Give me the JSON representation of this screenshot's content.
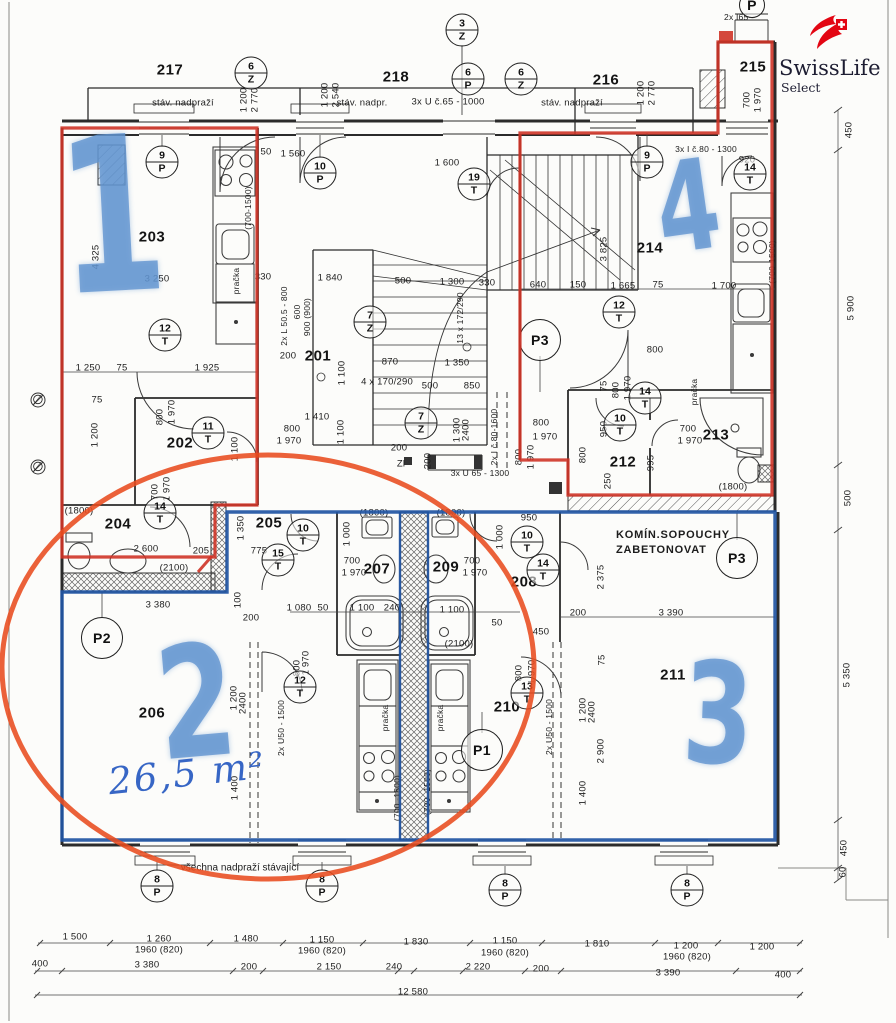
{
  "logo": {
    "title": "SwissLife",
    "subtitle": "Select"
  },
  "notes": {
    "area": "26,5 m²",
    "chimney_line1": "KOMÍN.SOPOUCHY",
    "chimney_line2": "ZABETONOVAT",
    "lintels": "všechna nadpraží stávající"
  },
  "colors": {
    "marker_red": "#cf3427",
    "ellipse_red": "#e84b1e",
    "outline_blue": "#2155a3",
    "handwritten_blue": "#6094d0",
    "logo_red": "#e30613",
    "wall": "#2b2b2b"
  },
  "apartment_marks": [
    {
      "n": "1",
      "x": 112,
      "y": 226,
      "s": 215,
      "rot": -3
    },
    {
      "n": "2",
      "x": 196,
      "y": 710,
      "s": 155,
      "rot": -5
    },
    {
      "n": "3",
      "x": 718,
      "y": 722,
      "s": 140,
      "rot": 2
    },
    {
      "n": "4",
      "x": 688,
      "y": 214,
      "s": 125,
      "rot": -8
    }
  ],
  "room_labels": [
    {
      "t": "217",
      "x": 170,
      "y": 70
    },
    {
      "t": "218",
      "x": 396,
      "y": 77
    },
    {
      "t": "216",
      "x": 606,
      "y": 80
    },
    {
      "t": "215",
      "x": 753,
      "y": 67
    },
    {
      "t": "203",
      "x": 152,
      "y": 237
    },
    {
      "t": "201",
      "x": 318,
      "y": 356
    },
    {
      "t": "202",
      "x": 180,
      "y": 443
    },
    {
      "t": "214",
      "x": 650,
      "y": 248
    },
    {
      "t": "212",
      "x": 623,
      "y": 462
    },
    {
      "t": "213",
      "x": 716,
      "y": 435
    },
    {
      "t": "204",
      "x": 118,
      "y": 524
    },
    {
      "t": "205",
      "x": 269,
      "y": 523
    },
    {
      "t": "207",
      "x": 377,
      "y": 569
    },
    {
      "t": "209",
      "x": 446,
      "y": 567
    },
    {
      "t": "208",
      "x": 524,
      "y": 582
    },
    {
      "t": "206",
      "x": 152,
      "y": 713
    },
    {
      "t": "210",
      "x": 507,
      "y": 707
    },
    {
      "t": "211",
      "x": 673,
      "y": 675
    }
  ],
  "circles": [
    {
      "t": "P",
      "x": 752,
      "y": 5,
      "d": 24,
      "plain": true
    },
    {
      "t": "3",
      "b": "Z",
      "x": 462,
      "y": 30
    },
    {
      "t": "6",
      "b": "Z",
      "x": 251,
      "y": 73
    },
    {
      "t": "6",
      "b": "P",
      "x": 468,
      "y": 79
    },
    {
      "t": "6",
      "b": "Z",
      "x": 521,
      "y": 79
    },
    {
      "t": "9",
      "b": "P",
      "x": 162,
      "y": 162
    },
    {
      "t": "10",
      "b": "P",
      "x": 320,
      "y": 173
    },
    {
      "t": "19",
      "b": "T",
      "x": 474,
      "y": 184
    },
    {
      "t": "9",
      "b": "P",
      "x": 647,
      "y": 162
    },
    {
      "t": "14",
      "b": "T",
      "x": 750,
      "y": 174
    },
    {
      "t": "12",
      "b": "T",
      "x": 165,
      "y": 335
    },
    {
      "t": "7",
      "b": "Z",
      "x": 370,
      "y": 322
    },
    {
      "t": "P3",
      "x": 540,
      "y": 340,
      "plain": true
    },
    {
      "t": "12",
      "b": "T",
      "x": 619,
      "y": 312
    },
    {
      "t": "11",
      "b": "T",
      "x": 208,
      "y": 433
    },
    {
      "t": "7",
      "b": "Z",
      "x": 421,
      "y": 423
    },
    {
      "t": "14",
      "b": "T",
      "x": 645,
      "y": 398
    },
    {
      "t": "10",
      "b": "T",
      "x": 620,
      "y": 425
    },
    {
      "t": "14",
      "b": "T",
      "x": 160,
      "y": 513
    },
    {
      "t": "10",
      "b": "T",
      "x": 303,
      "y": 535
    },
    {
      "t": "15",
      "b": "T",
      "x": 278,
      "y": 560
    },
    {
      "t": "10",
      "b": "T",
      "x": 527,
      "y": 542
    },
    {
      "t": "14",
      "b": "T",
      "x": 543,
      "y": 570
    },
    {
      "t": "P3",
      "x": 737,
      "y": 558,
      "plain": true
    },
    {
      "t": "P2",
      "x": 102,
      "y": 638,
      "plain": true
    },
    {
      "t": "12",
      "b": "T",
      "x": 300,
      "y": 687
    },
    {
      "t": "13",
      "b": "T",
      "x": 527,
      "y": 693
    },
    {
      "t": "P1",
      "x": 482,
      "y": 750,
      "plain": true
    },
    {
      "t": "8",
      "b": "P",
      "x": 157,
      "y": 886
    },
    {
      "t": "8",
      "b": "P",
      "x": 322,
      "y": 886
    },
    {
      "t": "8",
      "b": "P",
      "x": 505,
      "y": 890
    },
    {
      "t": "8",
      "b": "P",
      "x": 687,
      "y": 890
    }
  ],
  "dim_labels": [
    {
      "t": "stáv. nadpraží",
      "x": 183,
      "y": 103
    },
    {
      "t": "1 200",
      "x": 244,
      "y": 100,
      "r": 1
    },
    {
      "t": "2 770",
      "x": 255,
      "y": 100,
      "r": 1
    },
    {
      "t": "1 200",
      "x": 325,
      "y": 95,
      "r": 1
    },
    {
      "t": "2 540",
      "x": 336,
      "y": 95,
      "r": 1
    },
    {
      "t": "stáv. nadpr.",
      "x": 362,
      "y": 103
    },
    {
      "t": "3x U č.65 - 1000",
      "x": 448,
      "y": 102
    },
    {
      "t": "stáv. nadpraží",
      "x": 572,
      "y": 103
    },
    {
      "t": "1 200",
      "x": 641,
      "y": 93,
      "r": 1
    },
    {
      "t": "2 770",
      "x": 652,
      "y": 93,
      "r": 1
    },
    {
      "t": "2x I65 -",
      "x": 739,
      "y": 17,
      "fs": 8.5
    },
    {
      "t": "700",
      "x": 747,
      "y": 100,
      "r": 1
    },
    {
      "t": "1 970",
      "x": 758,
      "y": 100,
      "r": 1
    },
    {
      "t": "3x I č.80 - 1300",
      "x": 706,
      "y": 149,
      "fs": 8.5
    },
    {
      "t": "920",
      "x": 747,
      "y": 160
    },
    {
      "t": "50",
      "x": 266,
      "y": 152
    },
    {
      "t": "1 560",
      "x": 293,
      "y": 154
    },
    {
      "t": "1 600",
      "x": 447,
      "y": 163
    },
    {
      "t": "4 325",
      "x": 96,
      "y": 257,
      "r": 1
    },
    {
      "t": "3 250",
      "x": 157,
      "y": 279
    },
    {
      "t": "330",
      "x": 263,
      "y": 277
    },
    {
      "t": "pračka",
      "x": 236,
      "y": 281,
      "r": 1,
      "fs": 8.5
    },
    {
      "t": "(700-1500)",
      "x": 248,
      "y": 208,
      "r": 1,
      "fs": 8.5
    },
    {
      "t": "1 250",
      "x": 88,
      "y": 368
    },
    {
      "t": "75",
      "x": 122,
      "y": 368
    },
    {
      "t": "1 925",
      "x": 207,
      "y": 368
    },
    {
      "t": "1 200",
      "x": 95,
      "y": 435,
      "r": 1
    },
    {
      "t": "75",
      "x": 97,
      "y": 400
    },
    {
      "t": "800",
      "x": 160,
      "y": 417,
      "r": 1
    },
    {
      "t": "1 970",
      "x": 172,
      "y": 412,
      "r": 1
    },
    {
      "t": "1 100",
      "x": 235,
      "y": 449,
      "r": 1
    },
    {
      "t": "700",
      "x": 155,
      "y": 492,
      "r": 1
    },
    {
      "t": "1 970",
      "x": 167,
      "y": 489,
      "r": 1
    },
    {
      "t": "1 840",
      "x": 330,
      "y": 278
    },
    {
      "t": "500",
      "x": 403,
      "y": 281
    },
    {
      "t": "1 300",
      "x": 452,
      "y": 282
    },
    {
      "t": "330",
      "x": 487,
      "y": 283
    },
    {
      "t": "2x L 50.5 - 800",
      "x": 284,
      "y": 316,
      "r": 1,
      "fs": 8.5
    },
    {
      "t": "600",
      "x": 297,
      "y": 312,
      "r": 1,
      "fs": 8.5
    },
    {
      "t": "900 (900)",
      "x": 307,
      "y": 317,
      "r": 1,
      "fs": 8.5
    },
    {
      "t": "200",
      "x": 288,
      "y": 356
    },
    {
      "t": "1 100",
      "x": 342,
      "y": 373,
      "r": 1
    },
    {
      "t": "870",
      "x": 390,
      "y": 362
    },
    {
      "t": "1 350",
      "x": 457,
      "y": 363
    },
    {
      "t": "4 x 170/290",
      "x": 387,
      "y": 382
    },
    {
      "t": "500",
      "x": 430,
      "y": 386
    },
    {
      "t": "850",
      "x": 472,
      "y": 386
    },
    {
      "t": "13 x 172/290",
      "x": 460,
      "y": 318,
      "r": 1,
      "fs": 8.5
    },
    {
      "t": "1 410",
      "x": 317,
      "y": 417
    },
    {
      "t": "800",
      "x": 292,
      "y": 429
    },
    {
      "t": "1 970",
      "x": 289,
      "y": 441
    },
    {
      "t": "1 100",
      "x": 341,
      "y": 432,
      "r": 1
    },
    {
      "t": "1 300",
      "x": 457,
      "y": 430,
      "r": 1
    },
    {
      "t": "2400",
      "x": 466,
      "y": 430,
      "r": 1
    },
    {
      "t": "200",
      "x": 399,
      "y": 448
    },
    {
      "t": "Zl",
      "x": 401,
      "y": 464
    },
    {
      "t": "200",
      "x": 428,
      "y": 461,
      "r": 1
    },
    {
      "t": "3x U 65 - 1300",
      "x": 480,
      "y": 473,
      "fs": 8.5
    },
    {
      "t": "2x I č.80-1600",
      "x": 494,
      "y": 437,
      "r": 1,
      "fs": 8.5
    },
    {
      "t": "800",
      "x": 519,
      "y": 457,
      "r": 1
    },
    {
      "t": "1 970",
      "x": 531,
      "y": 457,
      "r": 1
    },
    {
      "t": "950",
      "x": 604,
      "y": 429,
      "r": 1
    },
    {
      "t": "800",
      "x": 583,
      "y": 455,
      "r": 1
    },
    {
      "t": "250",
      "x": 608,
      "y": 481,
      "r": 1
    },
    {
      "t": "800",
      "x": 541,
      "y": 423
    },
    {
      "t": "1 970",
      "x": 545,
      "y": 437
    },
    {
      "t": "3 825",
      "x": 604,
      "y": 249,
      "r": 1
    },
    {
      "t": "640",
      "x": 538,
      "y": 285
    },
    {
      "t": "150",
      "x": 578,
      "y": 285
    },
    {
      "t": "1 665",
      "x": 623,
      "y": 286
    },
    {
      "t": "75",
      "x": 658,
      "y": 285
    },
    {
      "t": "1 700",
      "x": 724,
      "y": 286
    },
    {
      "t": "(700-1500)",
      "x": 772,
      "y": 262,
      "r": 1,
      "fs": 8.5
    },
    {
      "t": "800",
      "x": 655,
      "y": 350
    },
    {
      "t": "75",
      "x": 604,
      "y": 386,
      "r": 1
    },
    {
      "t": "800",
      "x": 616,
      "y": 390,
      "r": 1
    },
    {
      "t": "1 970",
      "x": 628,
      "y": 388,
      "r": 1
    },
    {
      "t": "pračka",
      "x": 694,
      "y": 392,
      "r": 1,
      "fs": 8.5
    },
    {
      "t": "700",
      "x": 688,
      "y": 429
    },
    {
      "t": "1 970",
      "x": 690,
      "y": 441
    },
    {
      "t": "995",
      "x": 651,
      "y": 463,
      "r": 1
    },
    {
      "t": "(1800)",
      "x": 733,
      "y": 487
    },
    {
      "t": "(1800)",
      "x": 79,
      "y": 511
    },
    {
      "t": "(1800)",
      "x": 374,
      "y": 513
    },
    {
      "t": "(1800)",
      "x": 451,
      "y": 513
    },
    {
      "t": "2 600",
      "x": 146,
      "y": 549
    },
    {
      "t": "205",
      "x": 201,
      "y": 551
    },
    {
      "t": "(2100)",
      "x": 174,
      "y": 568
    },
    {
      "t": "1 350",
      "x": 241,
      "y": 528,
      "r": 1
    },
    {
      "t": "775",
      "x": 259,
      "y": 551
    },
    {
      "t": "1 000",
      "x": 347,
      "y": 534,
      "r": 1
    },
    {
      "t": "1 000",
      "x": 500,
      "y": 537,
      "r": 1
    },
    {
      "t": "700",
      "x": 352,
      "y": 561
    },
    {
      "t": "1 970",
      "x": 354,
      "y": 573
    },
    {
      "t": "700",
      "x": 472,
      "y": 561
    },
    {
      "t": "1 970",
      "x": 475,
      "y": 573
    },
    {
      "t": "950",
      "x": 529,
      "y": 518
    },
    {
      "t": "1 080",
      "x": 299,
      "y": 608
    },
    {
      "t": "50",
      "x": 323,
      "y": 608
    },
    {
      "t": "1 100",
      "x": 362,
      "y": 608
    },
    {
      "t": "240",
      "x": 392,
      "y": 608
    },
    {
      "t": "1 100",
      "x": 452,
      "y": 610
    },
    {
      "t": "50",
      "x": 497,
      "y": 623
    },
    {
      "t": "450",
      "x": 541,
      "y": 632
    },
    {
      "t": "(2100)",
      "x": 459,
      "y": 644
    },
    {
      "t": "200",
      "x": 578,
      "y": 613
    },
    {
      "t": "3 390",
      "x": 671,
      "y": 613
    },
    {
      "t": "2 375",
      "x": 601,
      "y": 577,
      "r": 1
    },
    {
      "t": "100",
      "x": 238,
      "y": 600,
      "r": 1
    },
    {
      "t": "3 380",
      "x": 158,
      "y": 605
    },
    {
      "t": "200",
      "x": 251,
      "y": 618
    },
    {
      "t": "800",
      "x": 297,
      "y": 668,
      "r": 1
    },
    {
      "t": "1 970",
      "x": 306,
      "y": 663,
      "r": 1
    },
    {
      "t": "1 200",
      "x": 234,
      "y": 698,
      "r": 1
    },
    {
      "t": "2400",
      "x": 243,
      "y": 703,
      "r": 1
    },
    {
      "t": "2x U50 - 1500",
      "x": 281,
      "y": 728,
      "r": 1,
      "fs": 8.5
    },
    {
      "t": "1 400",
      "x": 235,
      "y": 788,
      "r": 1
    },
    {
      "t": "pračka",
      "x": 385,
      "y": 718,
      "r": 1,
      "fs": 8.5
    },
    {
      "t": "pračka",
      "x": 440,
      "y": 718,
      "r": 1,
      "fs": 8.5
    },
    {
      "t": "(700 -1500)",
      "x": 397,
      "y": 798,
      "r": 1,
      "fs": 8.5
    },
    {
      "t": "(700 -1500)",
      "x": 427,
      "y": 792,
      "r": 1,
      "fs": 8.5
    },
    {
      "t": "800",
      "x": 519,
      "y": 673,
      "r": 1
    },
    {
      "t": "1 970",
      "x": 532,
      "y": 672,
      "r": 1
    },
    {
      "t": "2x U50 - 1500",
      "x": 549,
      "y": 727,
      "r": 1,
      "fs": 8.5
    },
    {
      "t": "75",
      "x": 602,
      "y": 660,
      "r": 1
    },
    {
      "t": "1 200",
      "x": 583,
      "y": 710,
      "r": 1
    },
    {
      "t": "2400",
      "x": 592,
      "y": 712,
      "r": 1
    },
    {
      "t": "2 900",
      "x": 601,
      "y": 751,
      "r": 1
    },
    {
      "t": "1 400",
      "x": 583,
      "y": 793,
      "r": 1
    },
    {
      "t": "1 500",
      "x": 75,
      "y": 937
    },
    {
      "t": "1 260",
      "x": 159,
      "y": 939
    },
    {
      "t": "1960 (820)",
      "x": 159,
      "y": 950
    },
    {
      "t": "1 480",
      "x": 246,
      "y": 939
    },
    {
      "t": "1 150",
      "x": 322,
      "y": 940
    },
    {
      "t": "1960 (820)",
      "x": 322,
      "y": 951
    },
    {
      "t": "1 830",
      "x": 416,
      "y": 942
    },
    {
      "t": "1 150",
      "x": 505,
      "y": 941
    },
    {
      "t": "1960 (820)",
      "x": 505,
      "y": 953
    },
    {
      "t": "1 810",
      "x": 597,
      "y": 944
    },
    {
      "t": "1 200",
      "x": 686,
      "y": 946
    },
    {
      "t": "1960 (820)",
      "x": 687,
      "y": 957
    },
    {
      "t": "1 200",
      "x": 762,
      "y": 947
    },
    {
      "t": "400",
      "x": 40,
      "y": 964
    },
    {
      "t": "3 380",
      "x": 147,
      "y": 965
    },
    {
      "t": "200",
      "x": 249,
      "y": 967
    },
    {
      "t": "2 150",
      "x": 329,
      "y": 967
    },
    {
      "t": "240",
      "x": 394,
      "y": 967
    },
    {
      "t": "2 220",
      "x": 478,
      "y": 967
    },
    {
      "t": "200",
      "x": 541,
      "y": 969
    },
    {
      "t": "3 390",
      "x": 668,
      "y": 973
    },
    {
      "t": "400",
      "x": 783,
      "y": 975
    },
    {
      "t": "12 580",
      "x": 413,
      "y": 992
    },
    {
      "t": "450",
      "x": 849,
      "y": 130,
      "r": 1
    },
    {
      "t": "5 900",
      "x": 851,
      "y": 308,
      "r": 1
    },
    {
      "t": "500",
      "x": 848,
      "y": 498,
      "r": 1
    },
    {
      "t": "5 350",
      "x": 847,
      "y": 675,
      "r": 1
    },
    {
      "t": "450",
      "x": 844,
      "y": 848,
      "r": 1
    },
    {
      "t": "60",
      "x": 843,
      "y": 872,
      "r": 1
    },
    {
      "t": "∅",
      "x": 38,
      "y": 400,
      "fs": 13
    },
    {
      "t": "∅",
      "x": 38,
      "y": 467,
      "fs": 13
    }
  ]
}
